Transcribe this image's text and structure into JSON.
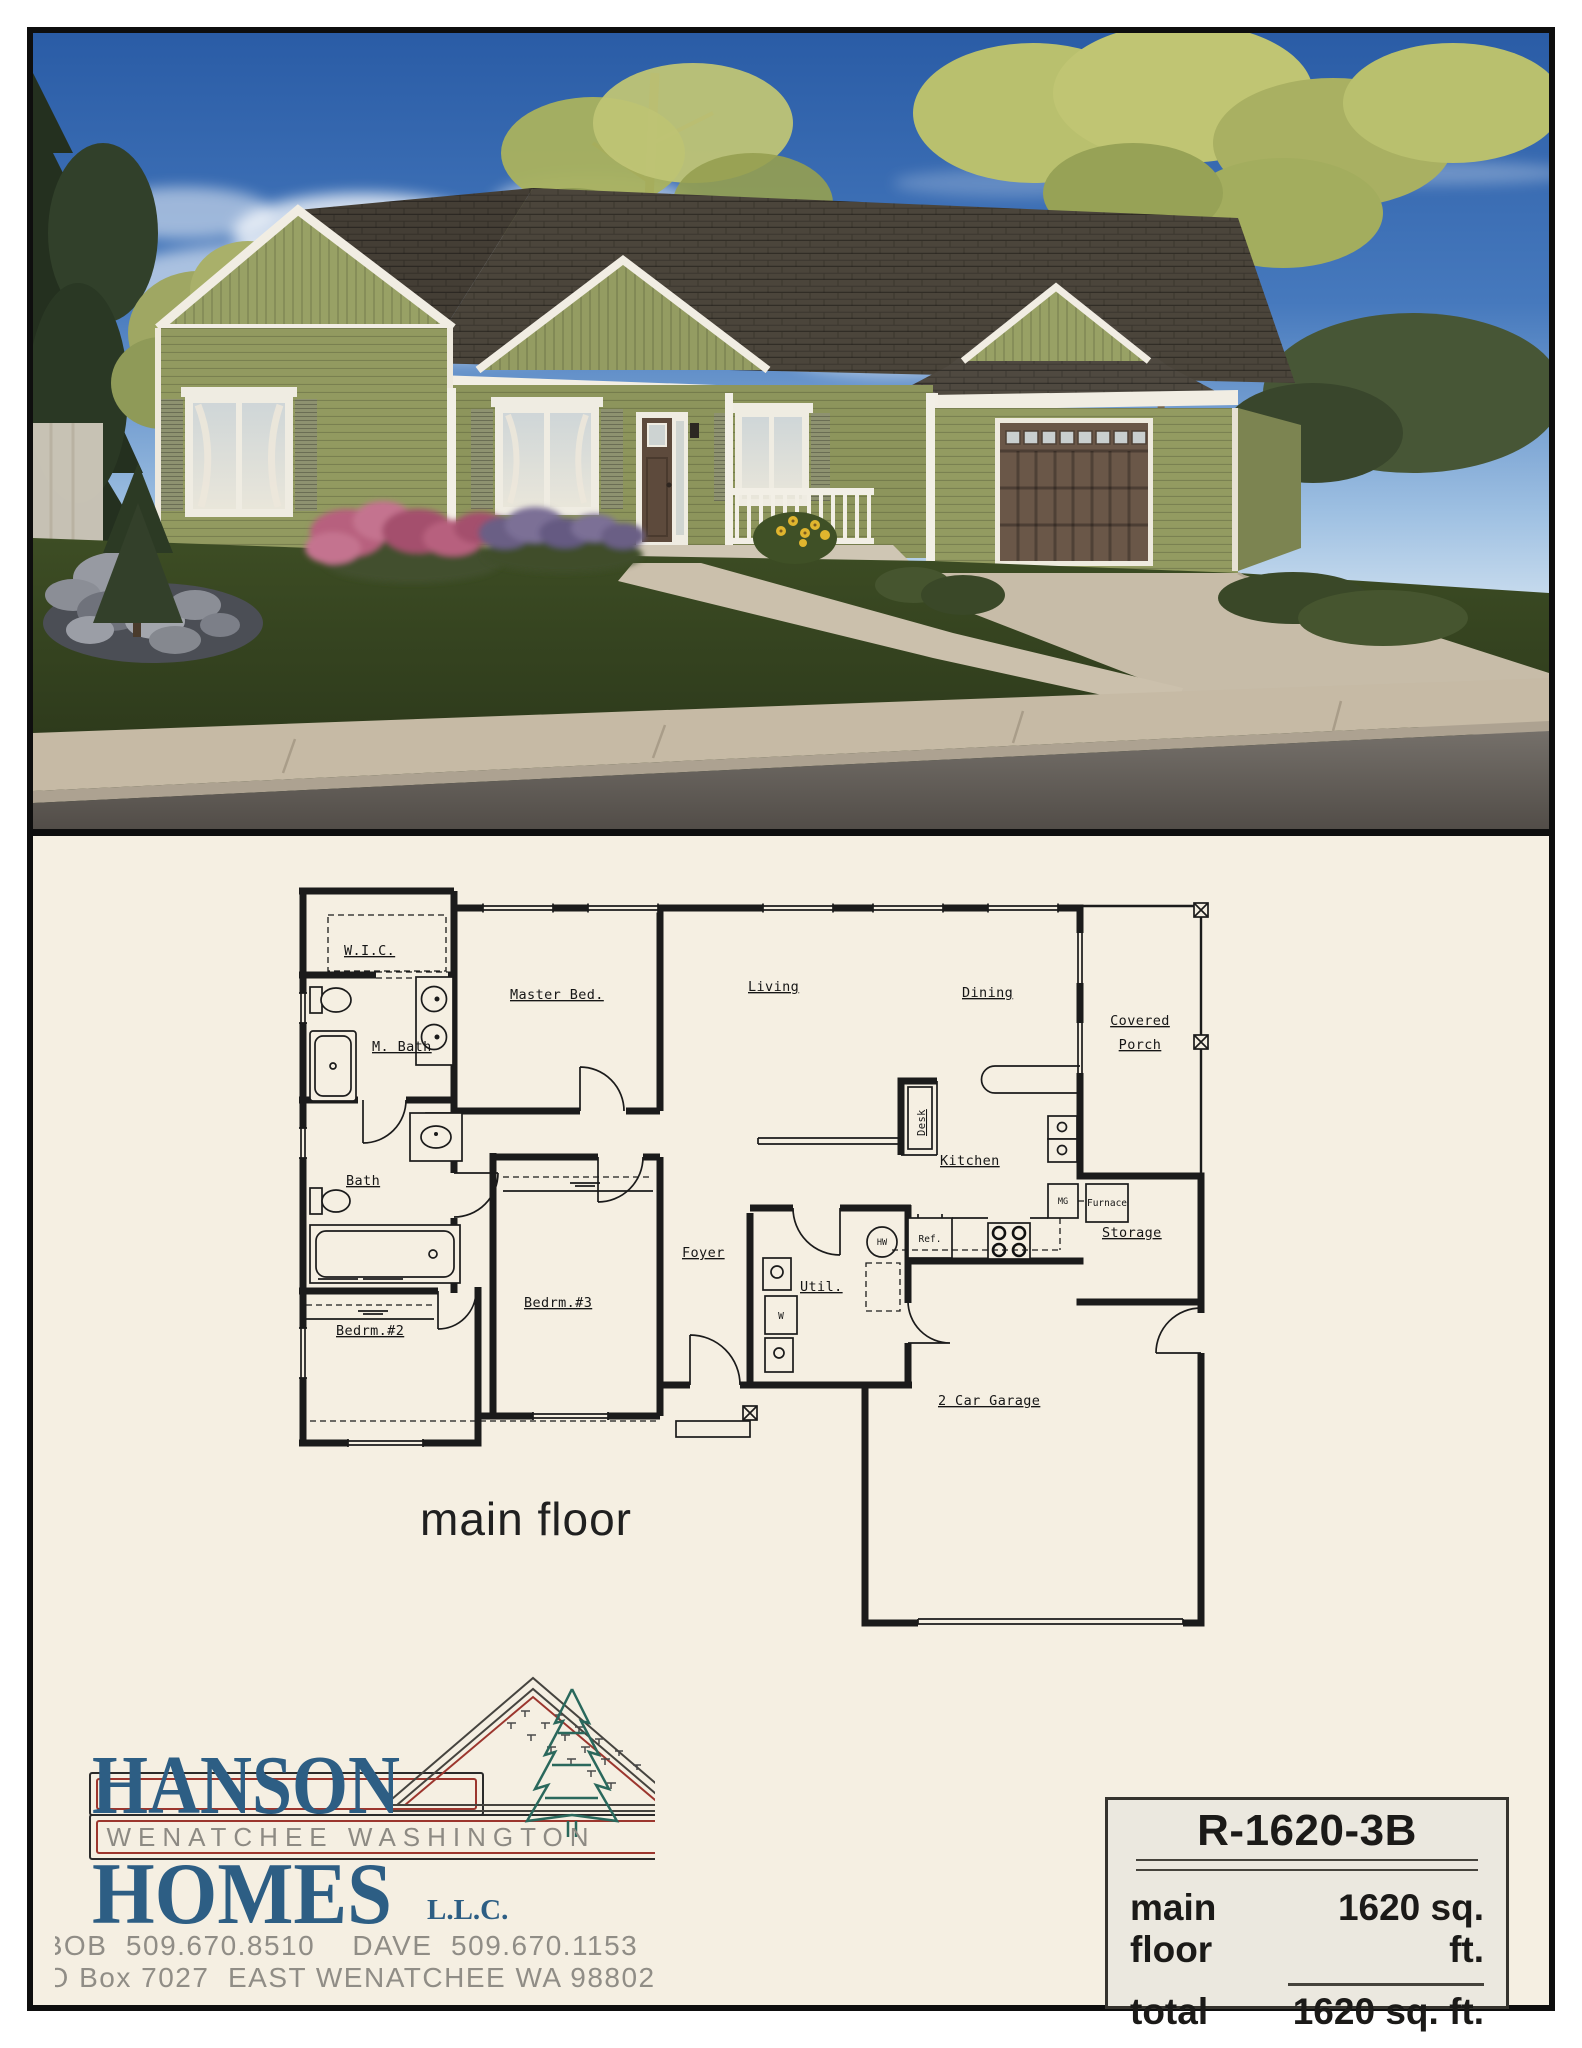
{
  "floor_plan": {
    "title": "main floor",
    "rooms": {
      "wic": "W.I.C.",
      "mbath": "M. Bath",
      "master": "Master Bed.",
      "bath": "Bath",
      "bed2": "Bedrm.#2",
      "bed3": "Bedrm.#3",
      "foyer": "Foyer",
      "living": "Living",
      "dining": "Dining",
      "porch_line1": "Covered",
      "porch_line2": "Porch",
      "kitchen": "Kitchen",
      "desk": "Desk",
      "util": "Util.",
      "storage": "Storage",
      "furnace": "Furnace",
      "garage": "2 Car Garage"
    },
    "fixtures": {
      "ref": "Ref.",
      "hw": "HW",
      "mg": "MG",
      "washer": "W"
    }
  },
  "logo": {
    "name_line1": "HANSON",
    "name_line2": "HOMES",
    "suffix": "L.L.C.",
    "banner": "WENATCHEE WASHINGTON",
    "contact_phone": "BOB  509.670.8510    DAVE  509.670.1153",
    "contact_address": "PO Box 7027  EAST WENATCHEE WA 98802"
  },
  "spec_table": {
    "model": "R-1620-3B",
    "rows": [
      {
        "label": "main floor",
        "value": "1620 sq. ft."
      },
      {
        "label": "total",
        "value": "1620 sq. ft."
      }
    ]
  },
  "palette": {
    "paper": "#f5efe2",
    "frame": "#0e0e0e",
    "plan_wall": "#1b1b1b",
    "logo_blue": "#2d5e84",
    "logo_red": "#9c362e",
    "logo_gray": "#908d86",
    "pine_teal": "#2a685c",
    "sky_top": "#2a5ca6",
    "roof_shingle": "#4b453b",
    "siding_green": "#939b61",
    "trim_white": "#f1ede3",
    "door_brown": "#5d4a3c",
    "garage_door_brown": "#6a5748",
    "lawn_green": "#33411e",
    "concrete": "#c7bca8",
    "road_gray": "#6b6560"
  }
}
